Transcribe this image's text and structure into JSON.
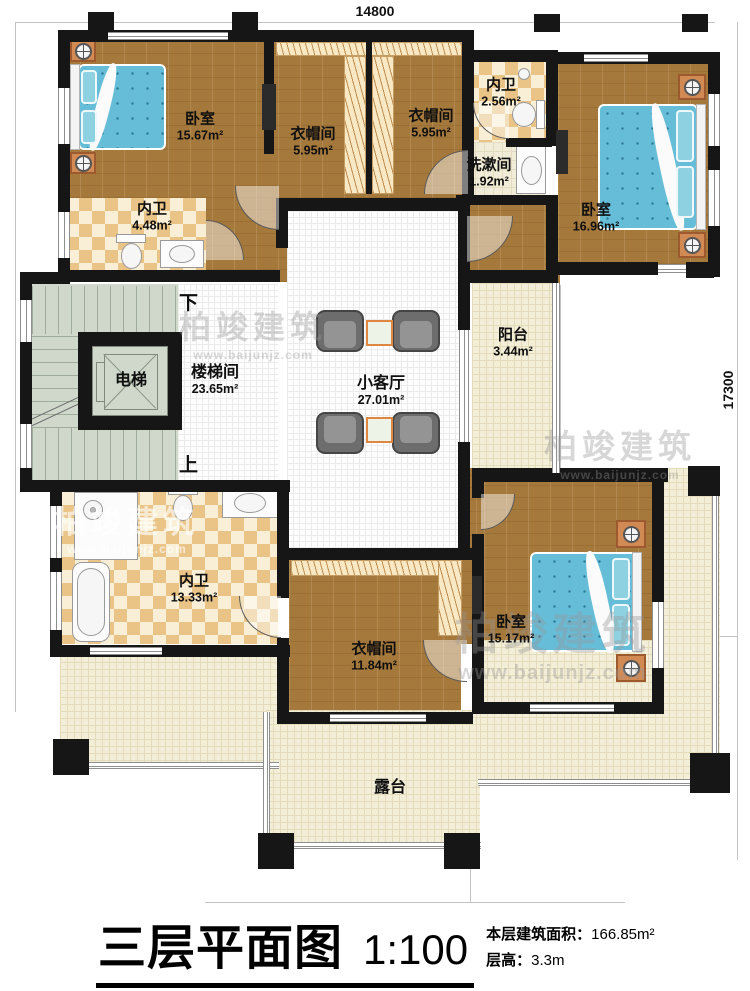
{
  "dimensions": {
    "top": "14800",
    "right": "17300"
  },
  "title": {
    "text": "三层平面图",
    "scale": "1:100",
    "area_label": "本层建筑面积：",
    "area_value": "166.85m²",
    "height_label": "层高：",
    "height_value": "3.3m"
  },
  "watermark": {
    "brand": "柏竣建筑",
    "url": "www.baijunjz.com"
  },
  "stairs": {
    "down": "下",
    "up": "上"
  },
  "rooms": {
    "bedroom_tl": {
      "name": "卧室",
      "area": "15.67m²"
    },
    "closet_t1": {
      "name": "衣帽间",
      "area": "5.95m²"
    },
    "closet_t2": {
      "name": "衣帽间",
      "area": "5.95m²"
    },
    "bath_tl": {
      "name": "内卫",
      "area": "4.48m²"
    },
    "bath_tr": {
      "name": "内卫",
      "area": "2.56m²"
    },
    "wash_tr": {
      "name": "洗漱间",
      "area": "1.92m²"
    },
    "bedroom_tr": {
      "name": "卧室",
      "area": "16.96m²"
    },
    "elevator": {
      "name": "电梯"
    },
    "stairwell": {
      "name": "楼梯间",
      "area": "23.65m²"
    },
    "living": {
      "name": "小客厅",
      "area": "27.01m²"
    },
    "balcony": {
      "name": "阳台",
      "area": "3.44m²"
    },
    "bath_bl": {
      "name": "内卫",
      "area": "13.33m²"
    },
    "closet_b": {
      "name": "衣帽间",
      "area": "11.84m²"
    },
    "bedroom_br": {
      "name": "卧室",
      "area": "15.17m²"
    },
    "terrace": {
      "name": "露台"
    }
  }
}
